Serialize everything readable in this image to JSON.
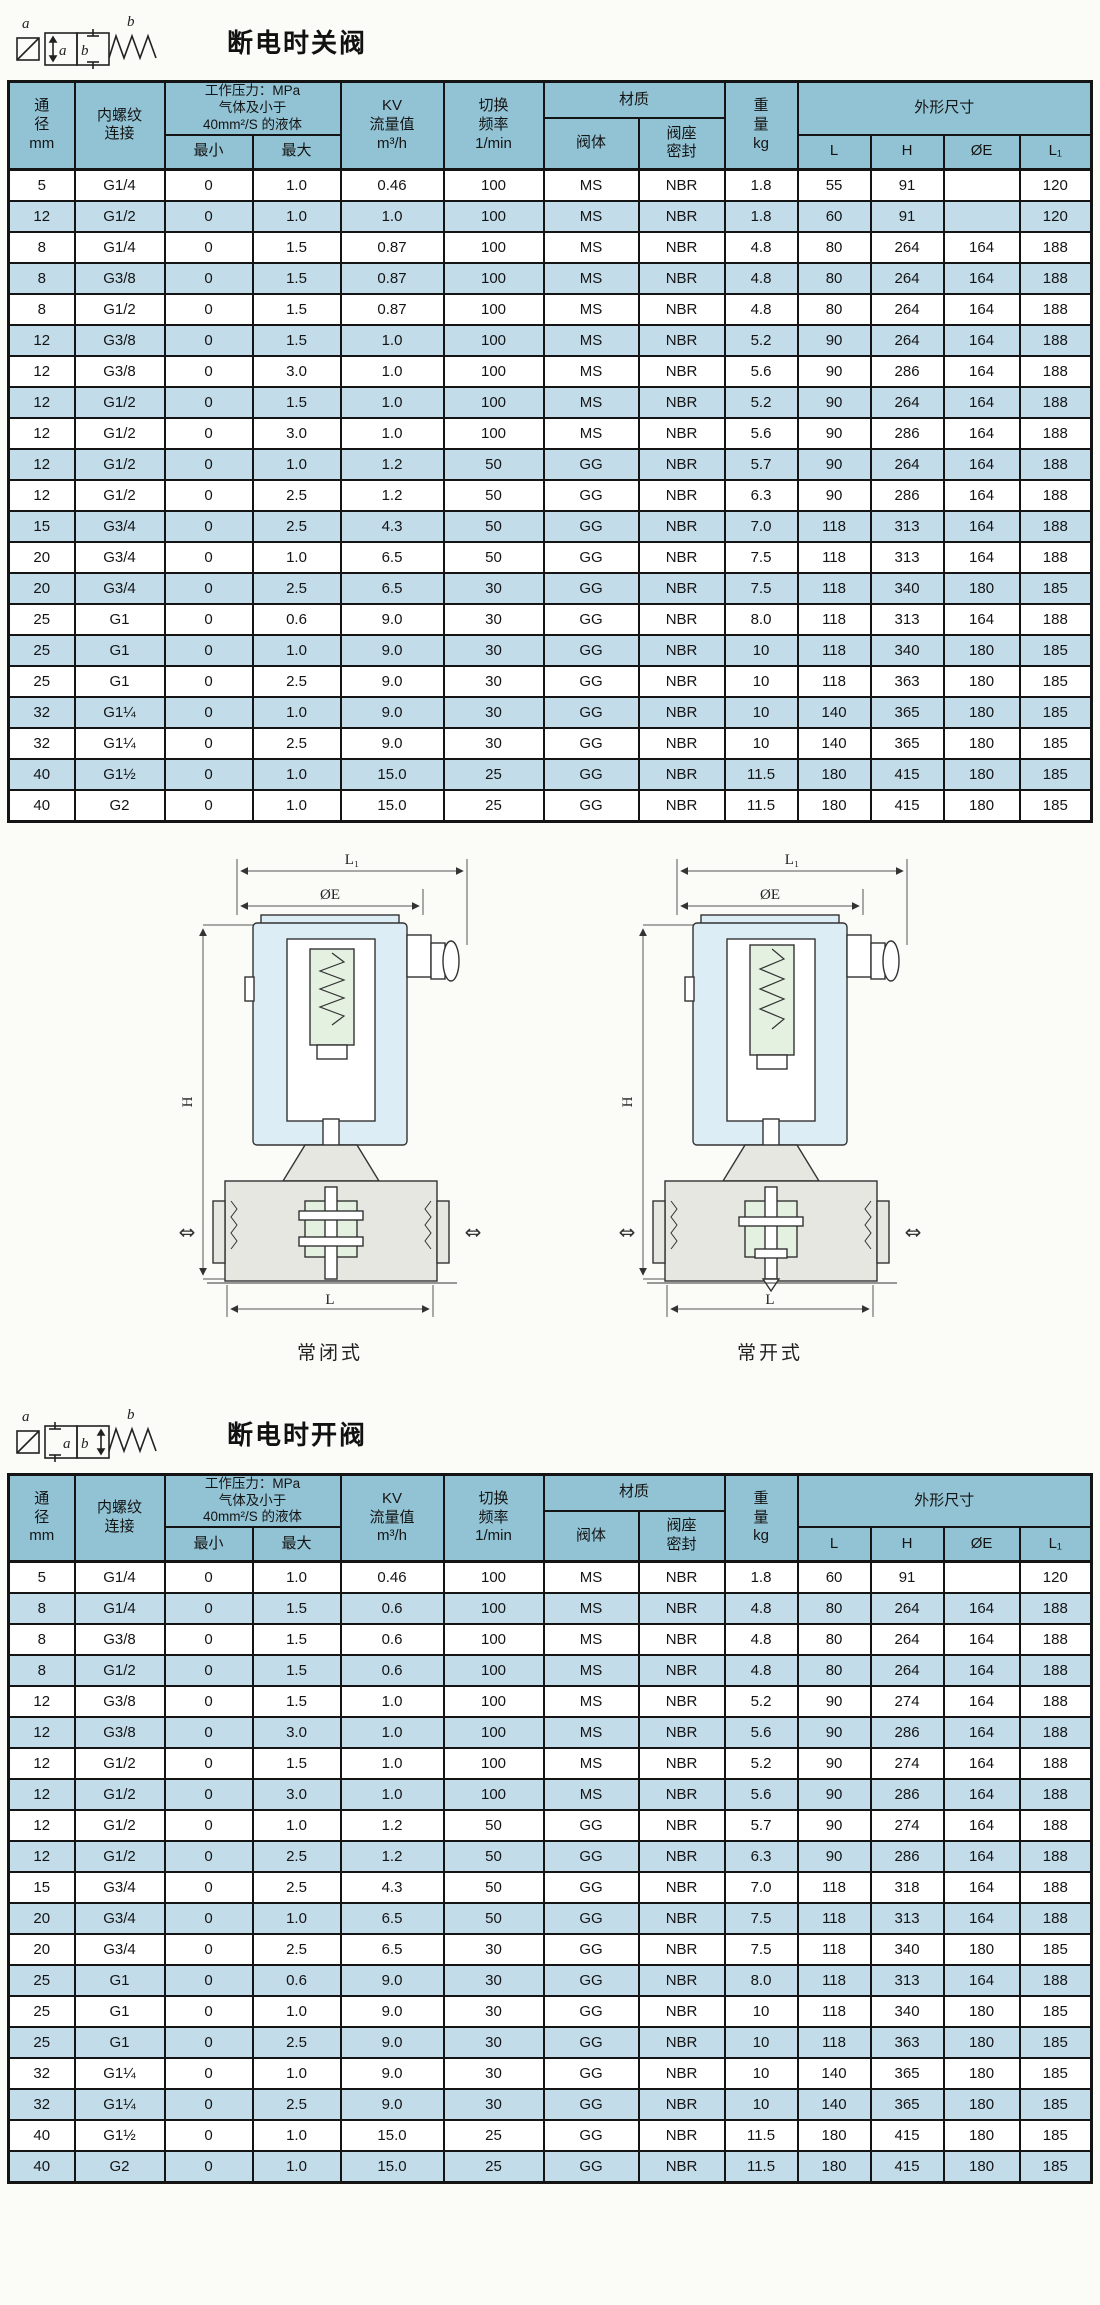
{
  "colors": {
    "header_bg": "#92c3d4",
    "row_alt_bg": "#c3dcea",
    "border": "#141414",
    "coil_fill": "#dcedf6",
    "spring_fill": "#e4f0e0",
    "body_fill": "#e7e7e2"
  },
  "section_close": {
    "title": "断电时关阀",
    "symbol": {
      "a": "a",
      "b": "b"
    }
  },
  "section_open": {
    "title": "断电时开阀",
    "symbol": {
      "a": "a",
      "b": "b"
    }
  },
  "header": {
    "dn": "通\n径\nmm",
    "thread": "内螺纹\n连接",
    "pressure": "工作压力：MPa\n气体及小于\n40mm²/S 的液体",
    "min": "最小",
    "max": "最大",
    "kv": "KV\n流量值\nm³/h",
    "freq": "切换\n频率\n1/min",
    "material": "材质",
    "body": "阀体",
    "seal": "阀座\n密封",
    "weight": "重\n量\nkg",
    "dims": "外形尺寸",
    "L": "L",
    "H": "H",
    "OE": "ØE",
    "L1": "L₁"
  },
  "table_close": {
    "rows": [
      [
        "5",
        "G1/4",
        "0",
        "1.0",
        "0.46",
        "100",
        "MS",
        "NBR",
        "1.8",
        "55",
        "91",
        "",
        "120"
      ],
      [
        "12",
        "G1/2",
        "0",
        "1.0",
        "1.0",
        "100",
        "MS",
        "NBR",
        "1.8",
        "60",
        "91",
        "",
        "120"
      ],
      [
        "8",
        "G1/4",
        "0",
        "1.5",
        "0.87",
        "100",
        "MS",
        "NBR",
        "4.8",
        "80",
        "264",
        "164",
        "188"
      ],
      [
        "8",
        "G3/8",
        "0",
        "1.5",
        "0.87",
        "100",
        "MS",
        "NBR",
        "4.8",
        "80",
        "264",
        "164",
        "188"
      ],
      [
        "8",
        "G1/2",
        "0",
        "1.5",
        "0.87",
        "100",
        "MS",
        "NBR",
        "4.8",
        "80",
        "264",
        "164",
        "188"
      ],
      [
        "12",
        "G3/8",
        "0",
        "1.5",
        "1.0",
        "100",
        "MS",
        "NBR",
        "5.2",
        "90",
        "264",
        "164",
        "188"
      ],
      [
        "12",
        "G3/8",
        "0",
        "3.0",
        "1.0",
        "100",
        "MS",
        "NBR",
        "5.6",
        "90",
        "286",
        "164",
        "188"
      ],
      [
        "12",
        "G1/2",
        "0",
        "1.5",
        "1.0",
        "100",
        "MS",
        "NBR",
        "5.2",
        "90",
        "264",
        "164",
        "188"
      ],
      [
        "12",
        "G1/2",
        "0",
        "3.0",
        "1.0",
        "100",
        "MS",
        "NBR",
        "5.6",
        "90",
        "286",
        "164",
        "188"
      ],
      [
        "12",
        "G1/2",
        "0",
        "1.0",
        "1.2",
        "50",
        "GG",
        "NBR",
        "5.7",
        "90",
        "264",
        "164",
        "188"
      ],
      [
        "12",
        "G1/2",
        "0",
        "2.5",
        "1.2",
        "50",
        "GG",
        "NBR",
        "6.3",
        "90",
        "286",
        "164",
        "188"
      ],
      [
        "15",
        "G3/4",
        "0",
        "2.5",
        "4.3",
        "50",
        "GG",
        "NBR",
        "7.0",
        "118",
        "313",
        "164",
        "188"
      ],
      [
        "20",
        "G3/4",
        "0",
        "1.0",
        "6.5",
        "50",
        "GG",
        "NBR",
        "7.5",
        "118",
        "313",
        "164",
        "188"
      ],
      [
        "20",
        "G3/4",
        "0",
        "2.5",
        "6.5",
        "30",
        "GG",
        "NBR",
        "7.5",
        "118",
        "340",
        "180",
        "185"
      ],
      [
        "25",
        "G1",
        "0",
        "0.6",
        "9.0",
        "30",
        "GG",
        "NBR",
        "8.0",
        "118",
        "313",
        "164",
        "188"
      ],
      [
        "25",
        "G1",
        "0",
        "1.0",
        "9.0",
        "30",
        "GG",
        "NBR",
        "10",
        "118",
        "340",
        "180",
        "185"
      ],
      [
        "25",
        "G1",
        "0",
        "2.5",
        "9.0",
        "30",
        "GG",
        "NBR",
        "10",
        "118",
        "363",
        "180",
        "185"
      ],
      [
        "32",
        "G1¼",
        "0",
        "1.0",
        "9.0",
        "30",
        "GG",
        "NBR",
        "10",
        "140",
        "365",
        "180",
        "185"
      ],
      [
        "32",
        "G1¼",
        "0",
        "2.5",
        "9.0",
        "30",
        "GG",
        "NBR",
        "10",
        "140",
        "365",
        "180",
        "185"
      ],
      [
        "40",
        "G1½",
        "0",
        "1.0",
        "15.0",
        "25",
        "GG",
        "NBR",
        "11.5",
        "180",
        "415",
        "180",
        "185"
      ],
      [
        "40",
        "G2",
        "0",
        "1.0",
        "15.0",
        "25",
        "GG",
        "NBR",
        "11.5",
        "180",
        "415",
        "180",
        "185"
      ]
    ]
  },
  "diagram": {
    "dim_l1": "L₁",
    "dim_oe": "ØE",
    "dim_h": "H",
    "dim_l": "L",
    "flow_arrow": "⇔",
    "left_caption": "常闭式",
    "right_caption": "常开式"
  },
  "table_open": {
    "rows": [
      [
        "5",
        "G1/4",
        "0",
        "1.0",
        "0.46",
        "100",
        "MS",
        "NBR",
        "1.8",
        "60",
        "91",
        "",
        "120"
      ],
      [
        "8",
        "G1/4",
        "0",
        "1.5",
        "0.6",
        "100",
        "MS",
        "NBR",
        "4.8",
        "80",
        "264",
        "164",
        "188"
      ],
      [
        "8",
        "G3/8",
        "0",
        "1.5",
        "0.6",
        "100",
        "MS",
        "NBR",
        "4.8",
        "80",
        "264",
        "164",
        "188"
      ],
      [
        "8",
        "G1/2",
        "0",
        "1.5",
        "0.6",
        "100",
        "MS",
        "NBR",
        "4.8",
        "80",
        "264",
        "164",
        "188"
      ],
      [
        "12",
        "G3/8",
        "0",
        "1.5",
        "1.0",
        "100",
        "MS",
        "NBR",
        "5.2",
        "90",
        "274",
        "164",
        "188"
      ],
      [
        "12",
        "G3/8",
        "0",
        "3.0",
        "1.0",
        "100",
        "MS",
        "NBR",
        "5.6",
        "90",
        "286",
        "164",
        "188"
      ],
      [
        "12",
        "G1/2",
        "0",
        "1.5",
        "1.0",
        "100",
        "MS",
        "NBR",
        "5.2",
        "90",
        "274",
        "164",
        "188"
      ],
      [
        "12",
        "G1/2",
        "0",
        "3.0",
        "1.0",
        "100",
        "MS",
        "NBR",
        "5.6",
        "90",
        "286",
        "164",
        "188"
      ],
      [
        "12",
        "G1/2",
        "0",
        "1.0",
        "1.2",
        "50",
        "GG",
        "NBR",
        "5.7",
        "90",
        "274",
        "164",
        "188"
      ],
      [
        "12",
        "G1/2",
        "0",
        "2.5",
        "1.2",
        "50",
        "GG",
        "NBR",
        "6.3",
        "90",
        "286",
        "164",
        "188"
      ],
      [
        "15",
        "G3/4",
        "0",
        "2.5",
        "4.3",
        "50",
        "GG",
        "NBR",
        "7.0",
        "118",
        "318",
        "164",
        "188"
      ],
      [
        "20",
        "G3/4",
        "0",
        "1.0",
        "6.5",
        "50",
        "GG",
        "NBR",
        "7.5",
        "118",
        "313",
        "164",
        "188"
      ],
      [
        "20",
        "G3/4",
        "0",
        "2.5",
        "6.5",
        "30",
        "GG",
        "NBR",
        "7.5",
        "118",
        "340",
        "180",
        "185"
      ],
      [
        "25",
        "G1",
        "0",
        "0.6",
        "9.0",
        "30",
        "GG",
        "NBR",
        "8.0",
        "118",
        "313",
        "164",
        "188"
      ],
      [
        "25",
        "G1",
        "0",
        "1.0",
        "9.0",
        "30",
        "GG",
        "NBR",
        "10",
        "118",
        "340",
        "180",
        "185"
      ],
      [
        "25",
        "G1",
        "0",
        "2.5",
        "9.0",
        "30",
        "GG",
        "NBR",
        "10",
        "118",
        "363",
        "180",
        "185"
      ],
      [
        "32",
        "G1¼",
        "0",
        "1.0",
        "9.0",
        "30",
        "GG",
        "NBR",
        "10",
        "140",
        "365",
        "180",
        "185"
      ],
      [
        "32",
        "G1¼",
        "0",
        "2.5",
        "9.0",
        "30",
        "GG",
        "NBR",
        "10",
        "140",
        "365",
        "180",
        "185"
      ],
      [
        "40",
        "G1½",
        "0",
        "1.0",
        "15.0",
        "25",
        "GG",
        "NBR",
        "11.5",
        "180",
        "415",
        "180",
        "185"
      ],
      [
        "40",
        "G2",
        "0",
        "1.0",
        "15.0",
        "25",
        "GG",
        "NBR",
        "11.5",
        "180",
        "415",
        "180",
        "185"
      ]
    ]
  }
}
